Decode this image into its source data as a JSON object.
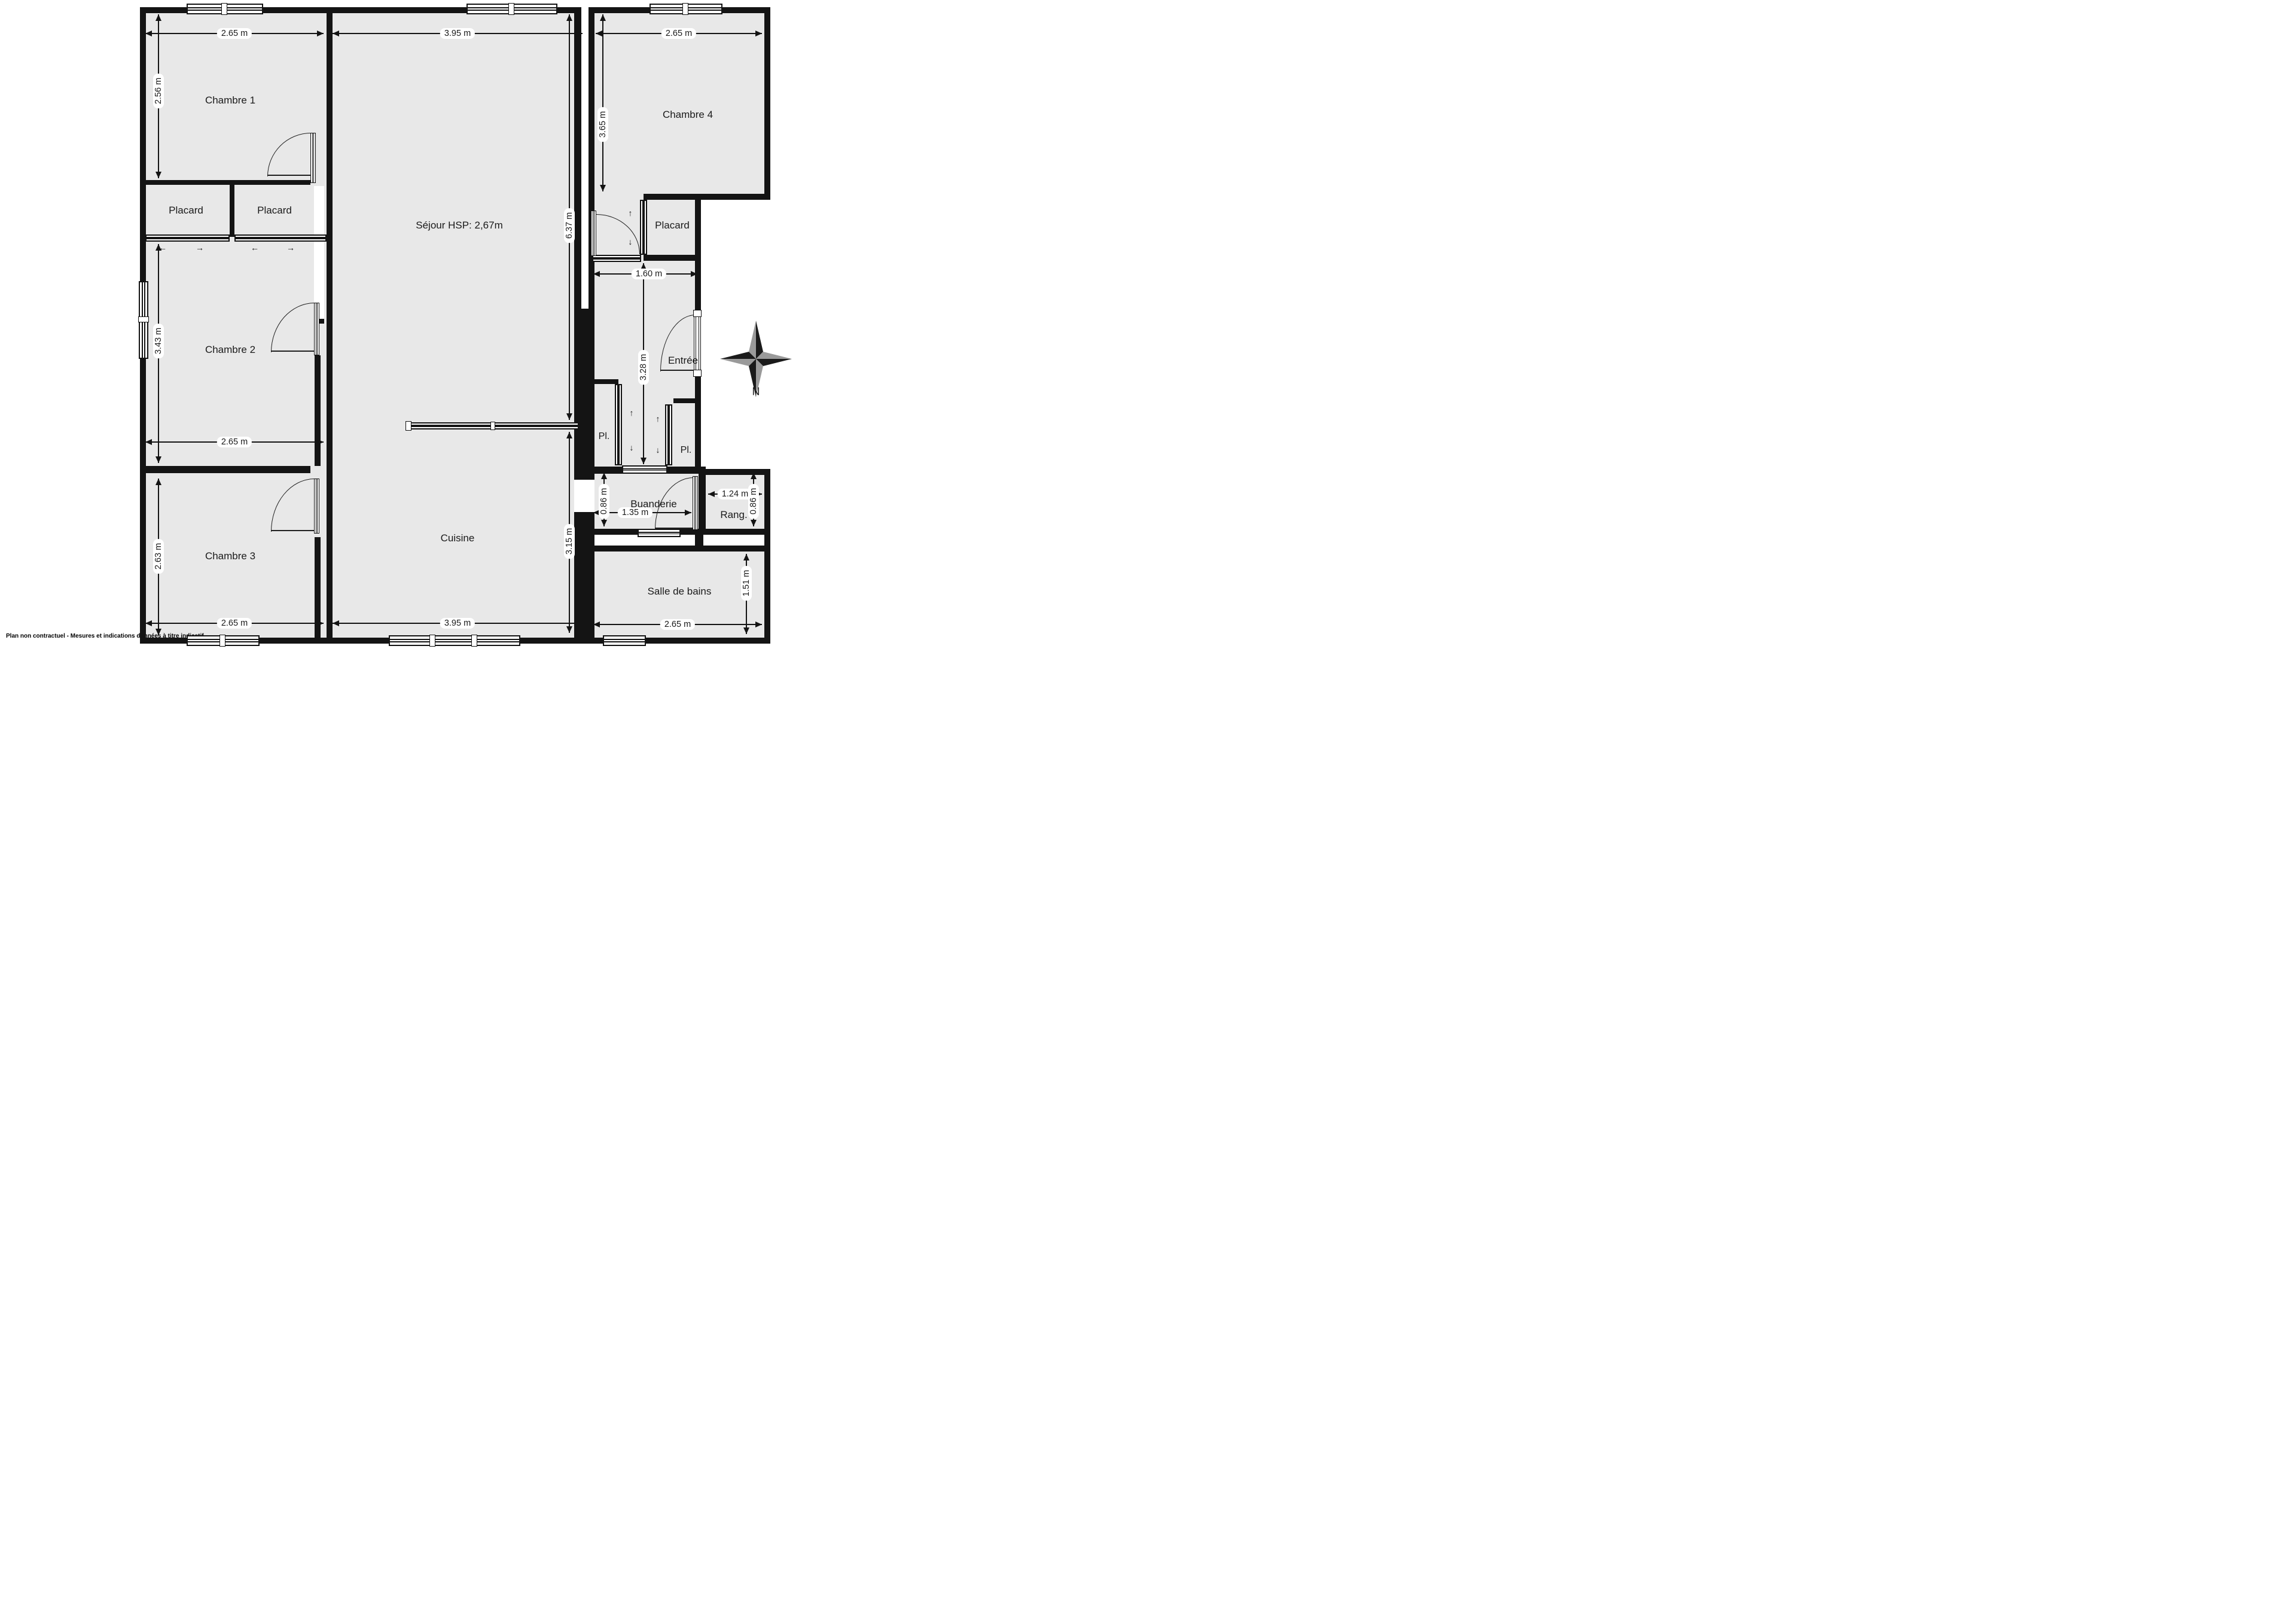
{
  "disclaimer": "Plan non contractuel - Mesures et indications données à titre indicatif",
  "compass": {
    "north_label": "N"
  },
  "colors": {
    "floor": "#e8e8e8",
    "wall": "#141414",
    "text": "#1a1a1a",
    "compass_dark": "#1a1a1a",
    "compass_gray": "#9a9a9a"
  },
  "icons": {
    "arrow_left": "←",
    "arrow_right": "→",
    "arrow_up": "↑",
    "arrow_down": "↓"
  },
  "rooms": {
    "chambre1": {
      "name": "Chambre 1",
      "width": "2.65 m",
      "height": "2.56 m"
    },
    "placard_gauche": {
      "name": "Placard"
    },
    "placard_droit": {
      "name": "Placard"
    },
    "chambre2": {
      "name": "Chambre 2",
      "width": "2.65 m",
      "height": "3.43 m"
    },
    "chambre3": {
      "name": "Chambre 3",
      "width": "2.65 m",
      "height": "2.63 m"
    },
    "sejour": {
      "name": "Séjour HSP: 2,67m",
      "width": "3.95 m",
      "height": "6.37 m"
    },
    "cuisine": {
      "name": "Cuisine",
      "width": "3.95 m",
      "height": "3.15 m"
    },
    "chambre4": {
      "name": "Chambre 4",
      "width": "2.65 m",
      "height": "3.65 m"
    },
    "placard_chambre4": {
      "name": "Placard",
      "width": "1.60 m"
    },
    "entree": {
      "name": "Entrée",
      "height": "3.28 m"
    },
    "pl_gauche": {
      "name": "Pl."
    },
    "pl_droit": {
      "name": "Pl."
    },
    "buanderie": {
      "name": "Buanderie",
      "width": "1.35 m",
      "height": "0.86 m"
    },
    "rangement": {
      "name": "Rang.",
      "width": "1.24 m",
      "height": "0.86 m"
    },
    "salle_de_bains": {
      "name": "Salle de bains",
      "width": "2.65 m",
      "height": "1.51 m"
    }
  }
}
